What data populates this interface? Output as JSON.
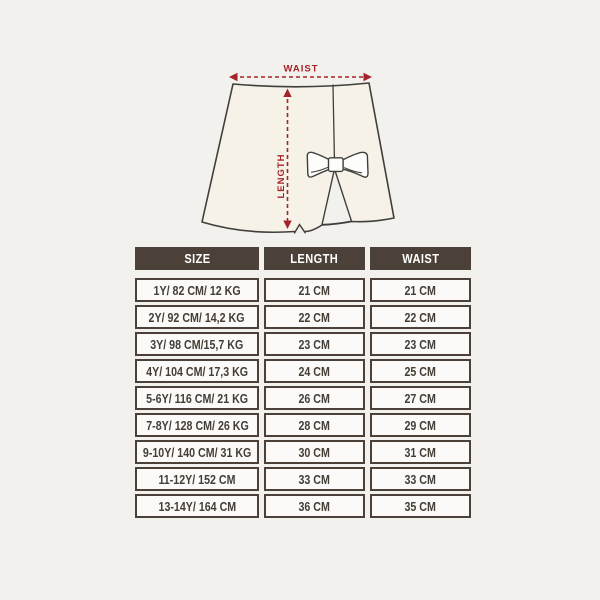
{
  "colors": {
    "bg": "#f2f1ee",
    "panel": "#fbfaf8",
    "brown": "#4b4139",
    "text": "#453d36",
    "red": "#a5232a",
    "cream": "#f7f2e8",
    "outline": "#413f3c",
    "white": "#fdfdfc"
  },
  "diagram": {
    "waist_label": "WAIST",
    "length_label": "LENGTH"
  },
  "table": {
    "headers": [
      "SIZE",
      "LENGTH",
      "WAIST"
    ],
    "rows": [
      {
        "size": "1Y/ 82 CM/ 12 KG",
        "length": "21 CM",
        "waist": "21 CM"
      },
      {
        "size": "2Y/ 92 CM/ 14,2 KG",
        "length": "22 CM",
        "waist": "22 CM"
      },
      {
        "size": "3Y/ 98 CM/15,7 KG",
        "length": "23 CM",
        "waist": "23 CM"
      },
      {
        "size": "4Y/ 104 CM/ 17,3 KG",
        "length": "24 CM",
        "waist": "25 CM"
      },
      {
        "size": "5-6Y/ 116 CM/ 21 KG",
        "length": "26 CM",
        "waist": "27 CM"
      },
      {
        "size": "7-8Y/ 128 CM/ 26 KG",
        "length": "28 CM",
        "waist": "29 CM"
      },
      {
        "size": "9-10Y/ 140 CM/ 31 KG",
        "length": "30 CM",
        "waist": "31 CM"
      },
      {
        "size": "11-12Y/ 152 CM",
        "length": "33 CM",
        "waist": "33 CM"
      },
      {
        "size": "13-14Y/ 164 CM",
        "length": "36 CM",
        "waist": "35 CM"
      }
    ]
  }
}
